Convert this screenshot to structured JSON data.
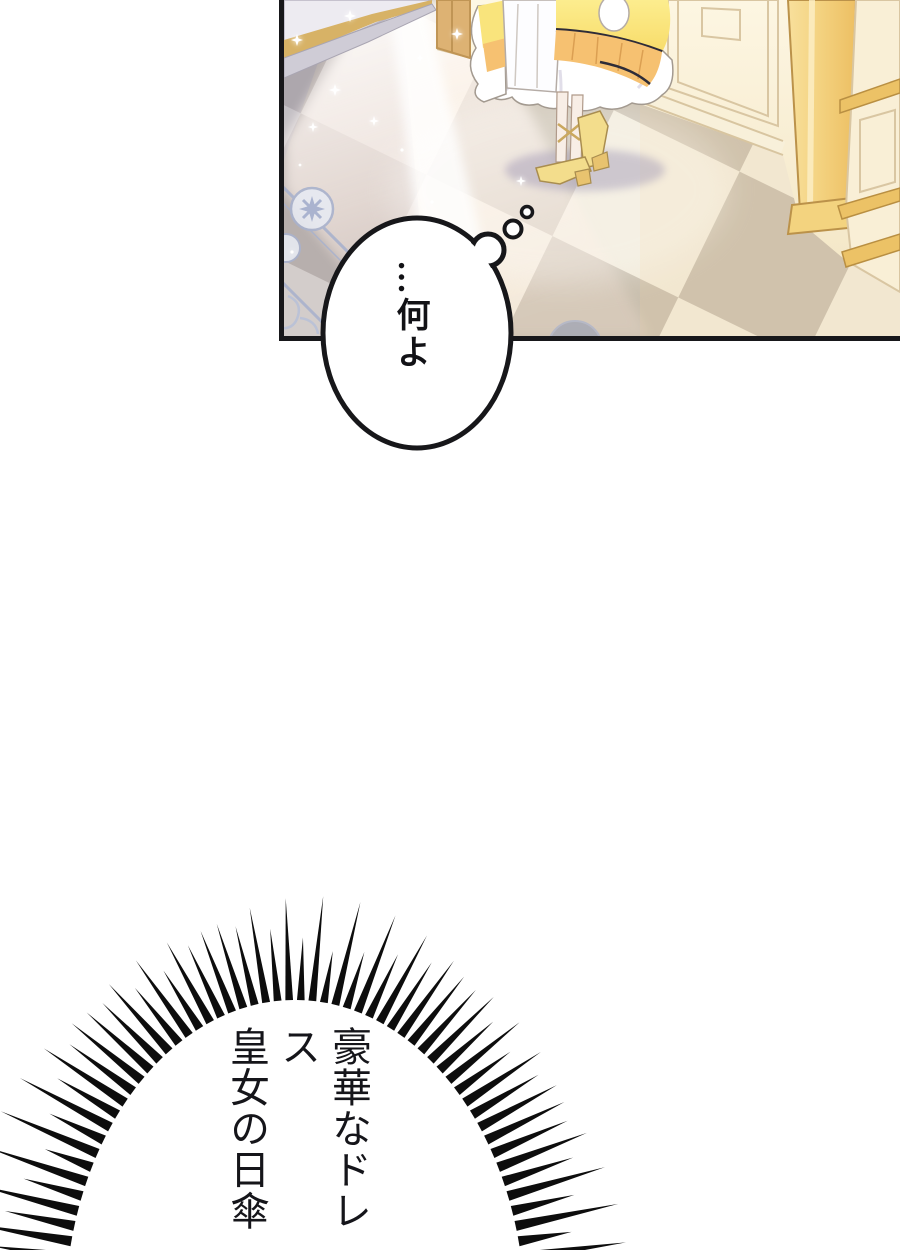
{
  "thought_bubble": {
    "text": "…何よ"
  },
  "burst": {
    "lines": [
      "豪華なドレス",
      "皇女の日傘を",
      "パーティーに"
    ]
  },
  "panel": {
    "border_color": "#17171a",
    "colors": {
      "floor_light": "#f1ead9",
      "floor_dark": "#c9bfae",
      "wall_cream_top": "#fdf6e2",
      "wall_cream_bottom": "#f3e6c5",
      "gold_light": "#f8e09c",
      "gold_dark": "#edbf63",
      "door_frame_tan": "#ddb273",
      "dress_yellow_light": "#fced8e",
      "dress_yellow": "#f8dc6a",
      "dress_orange": "#f6c171",
      "dress_trim_dark": "#2e2c38",
      "frill_white": "#ffffff",
      "shadow_lavender": "#9a97b8",
      "inlay_blue": "#a9b2cd",
      "spike_black": "#0d0d0d"
    }
  }
}
